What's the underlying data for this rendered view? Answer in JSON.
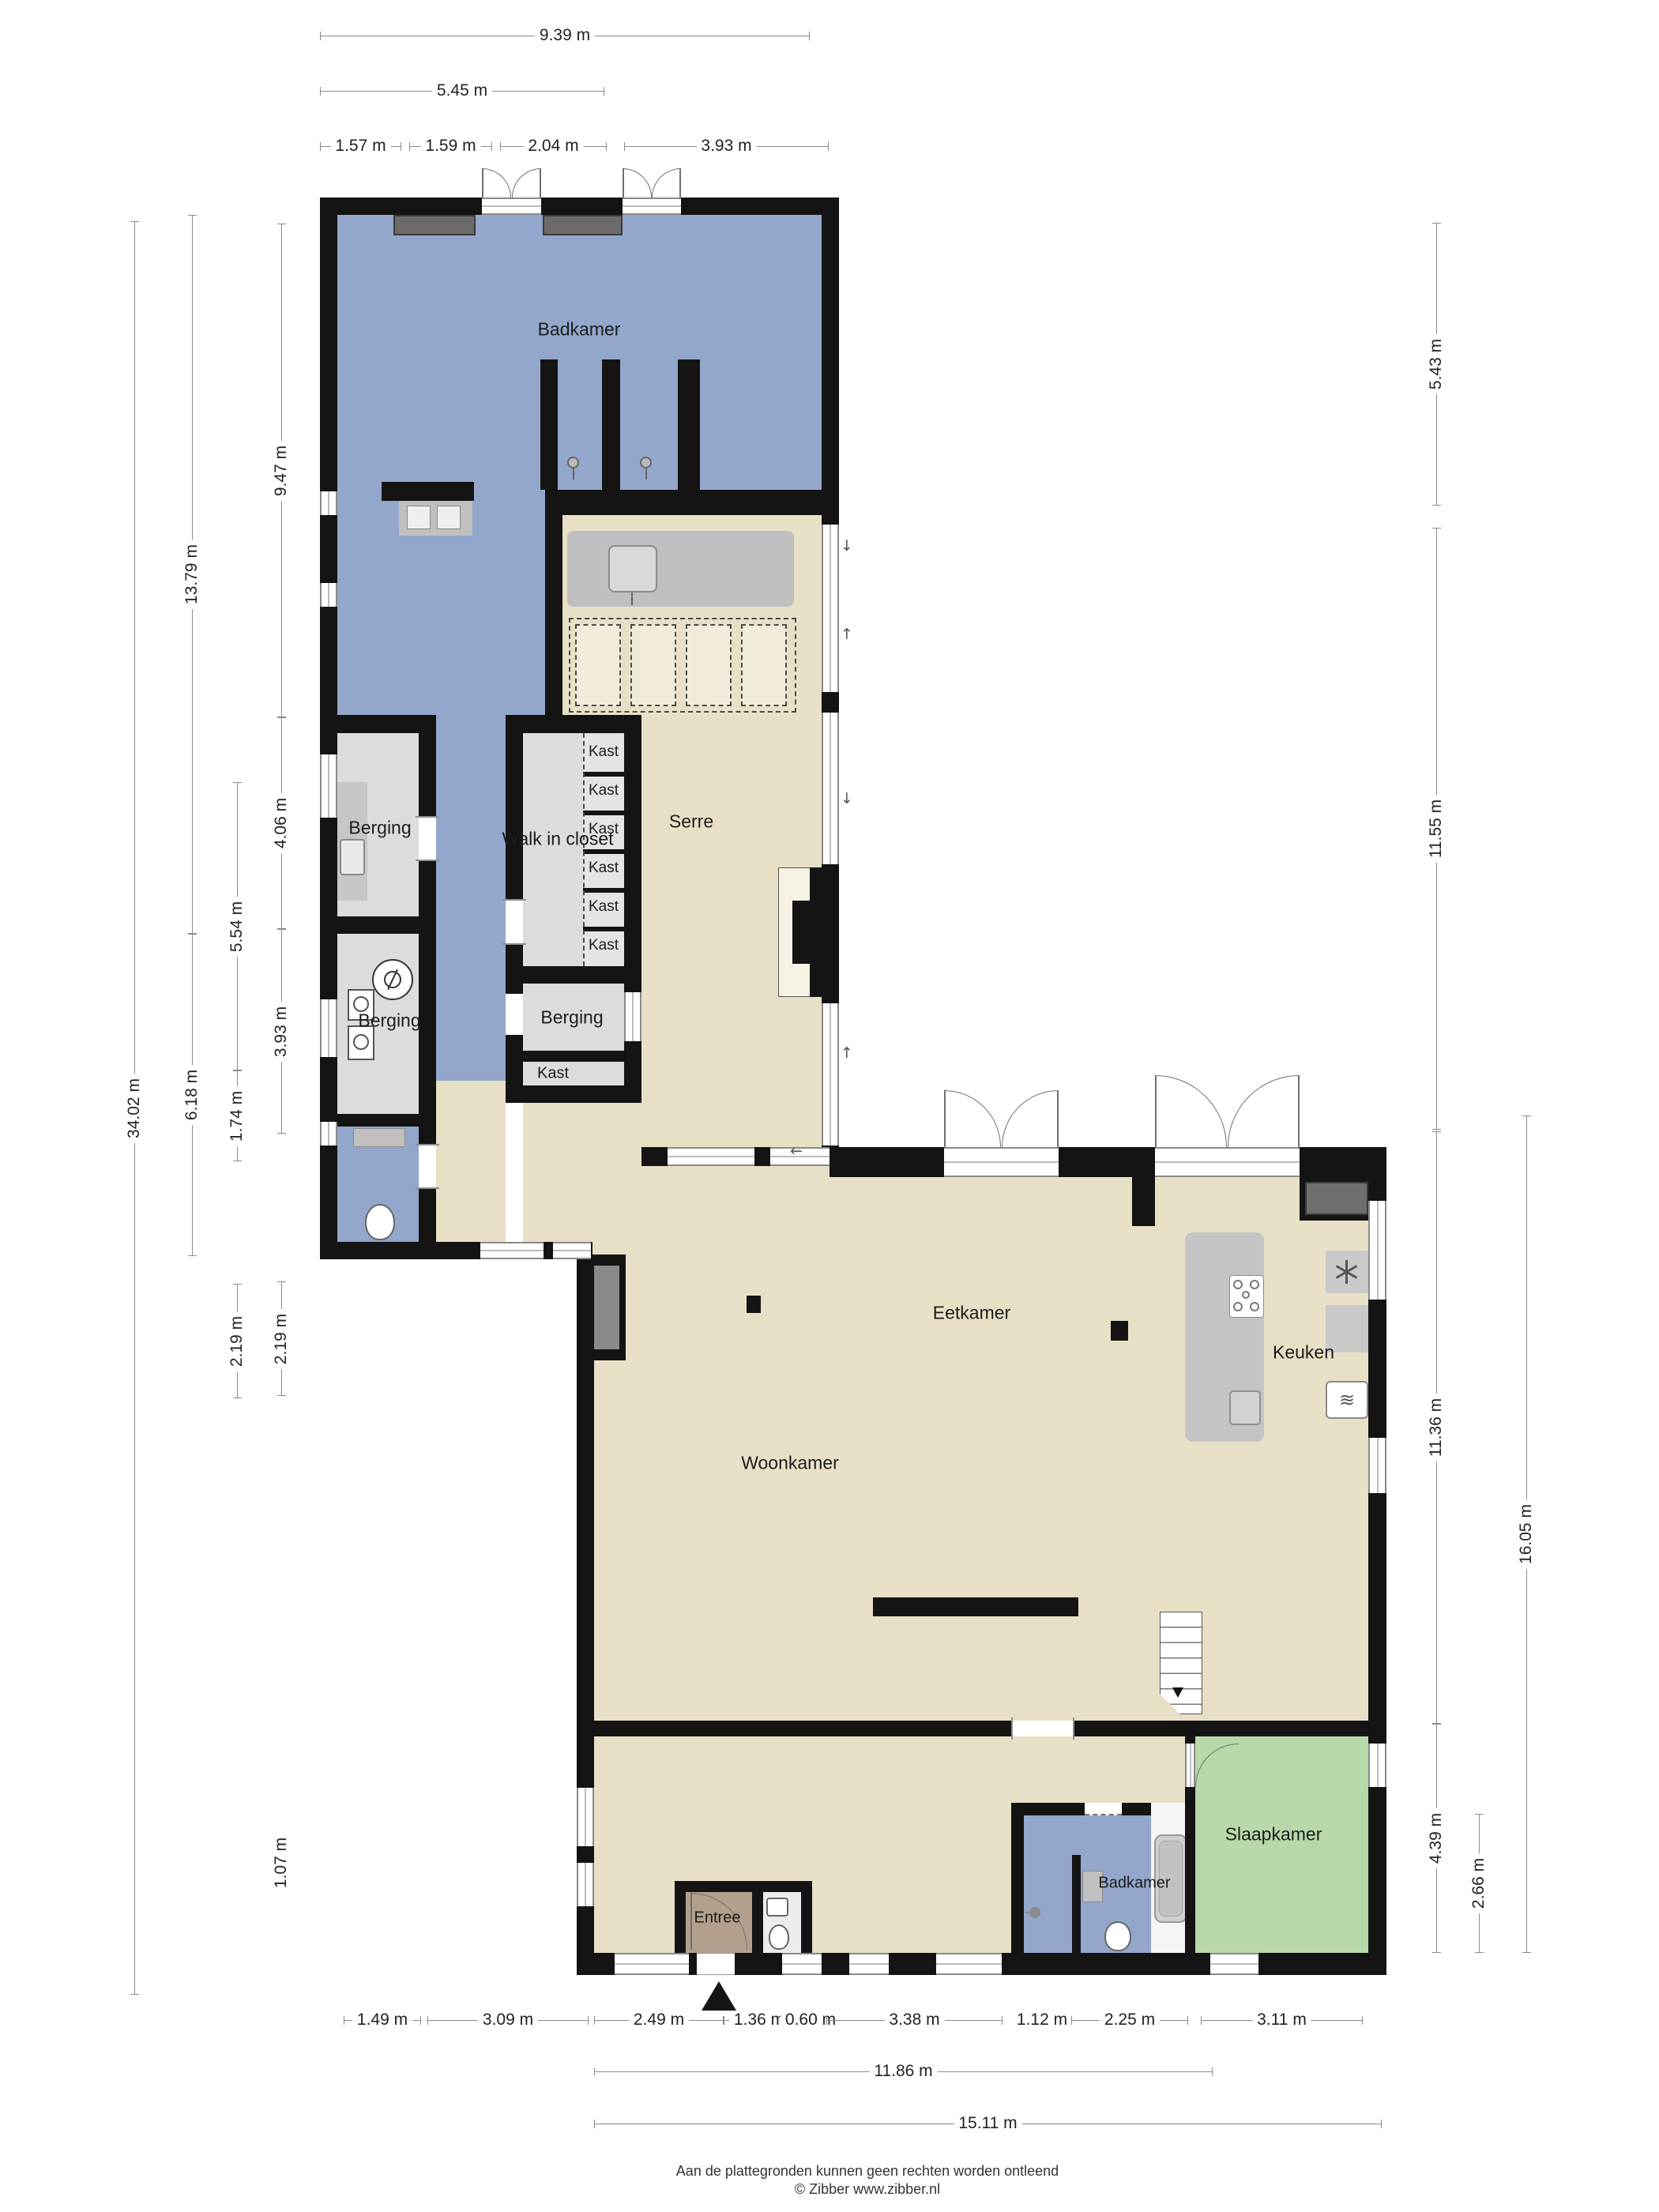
{
  "plan": {
    "rooms": {
      "badkamer_top": "Badkamer",
      "serre": "Serre",
      "berging_1": "Berging",
      "berging_2": "Berging",
      "berging_3": "Berging",
      "walk_in_closet": "Walk in closet",
      "kast_cells": [
        "Kast",
        "Kast",
        "Kast",
        "Kast",
        "Kast",
        "Kast"
      ],
      "kast_room": "Kast",
      "eetkamer": "Eetkamer",
      "woonkamer": "Woonkamer",
      "keuken": "Keuken",
      "entree": "Entree",
      "badkamer_beneden": "Badkamer",
      "slaapkamer": "Slaapkamer"
    },
    "dims": {
      "top": [
        "9.39 m",
        "5.45 m",
        "1.57 m",
        "1.59 m",
        "2.04 m",
        "3.93 m"
      ],
      "left": [
        "34.02 m",
        "13.79 m",
        "6.18 m",
        "5.54 m",
        "1.74 m",
        "2.19 m",
        "9.47 m",
        "4.06 m",
        "3.93 m",
        "2.19 m",
        "1.07 m"
      ],
      "right": [
        "5.43 m",
        "11.55 m",
        "11.36 m",
        "4.39 m",
        "2.66 m",
        "16.05 m"
      ],
      "bottom": [
        "1.49 m",
        "3.09 m",
        "2.49 m",
        "1.36 m",
        "0.60 m",
        "3.38 m",
        "1.12 m",
        "2.25 m",
        "3.11 m",
        "11.86 m",
        "15.11 m"
      ]
    },
    "footer": {
      "disclaimer": "Aan de plattegronden kunnen geen rechten worden ontleend",
      "credit": "© Zibber www.zibber.nl"
    },
    "colors": {
      "wall": "#141414",
      "floor_beige": "#e8e0c6",
      "floor_blue": "#92a7cb",
      "floor_green": "#b7d9a9",
      "floor_gray": "#dcdcdc",
      "entree_brown": "#b2a08c"
    }
  }
}
